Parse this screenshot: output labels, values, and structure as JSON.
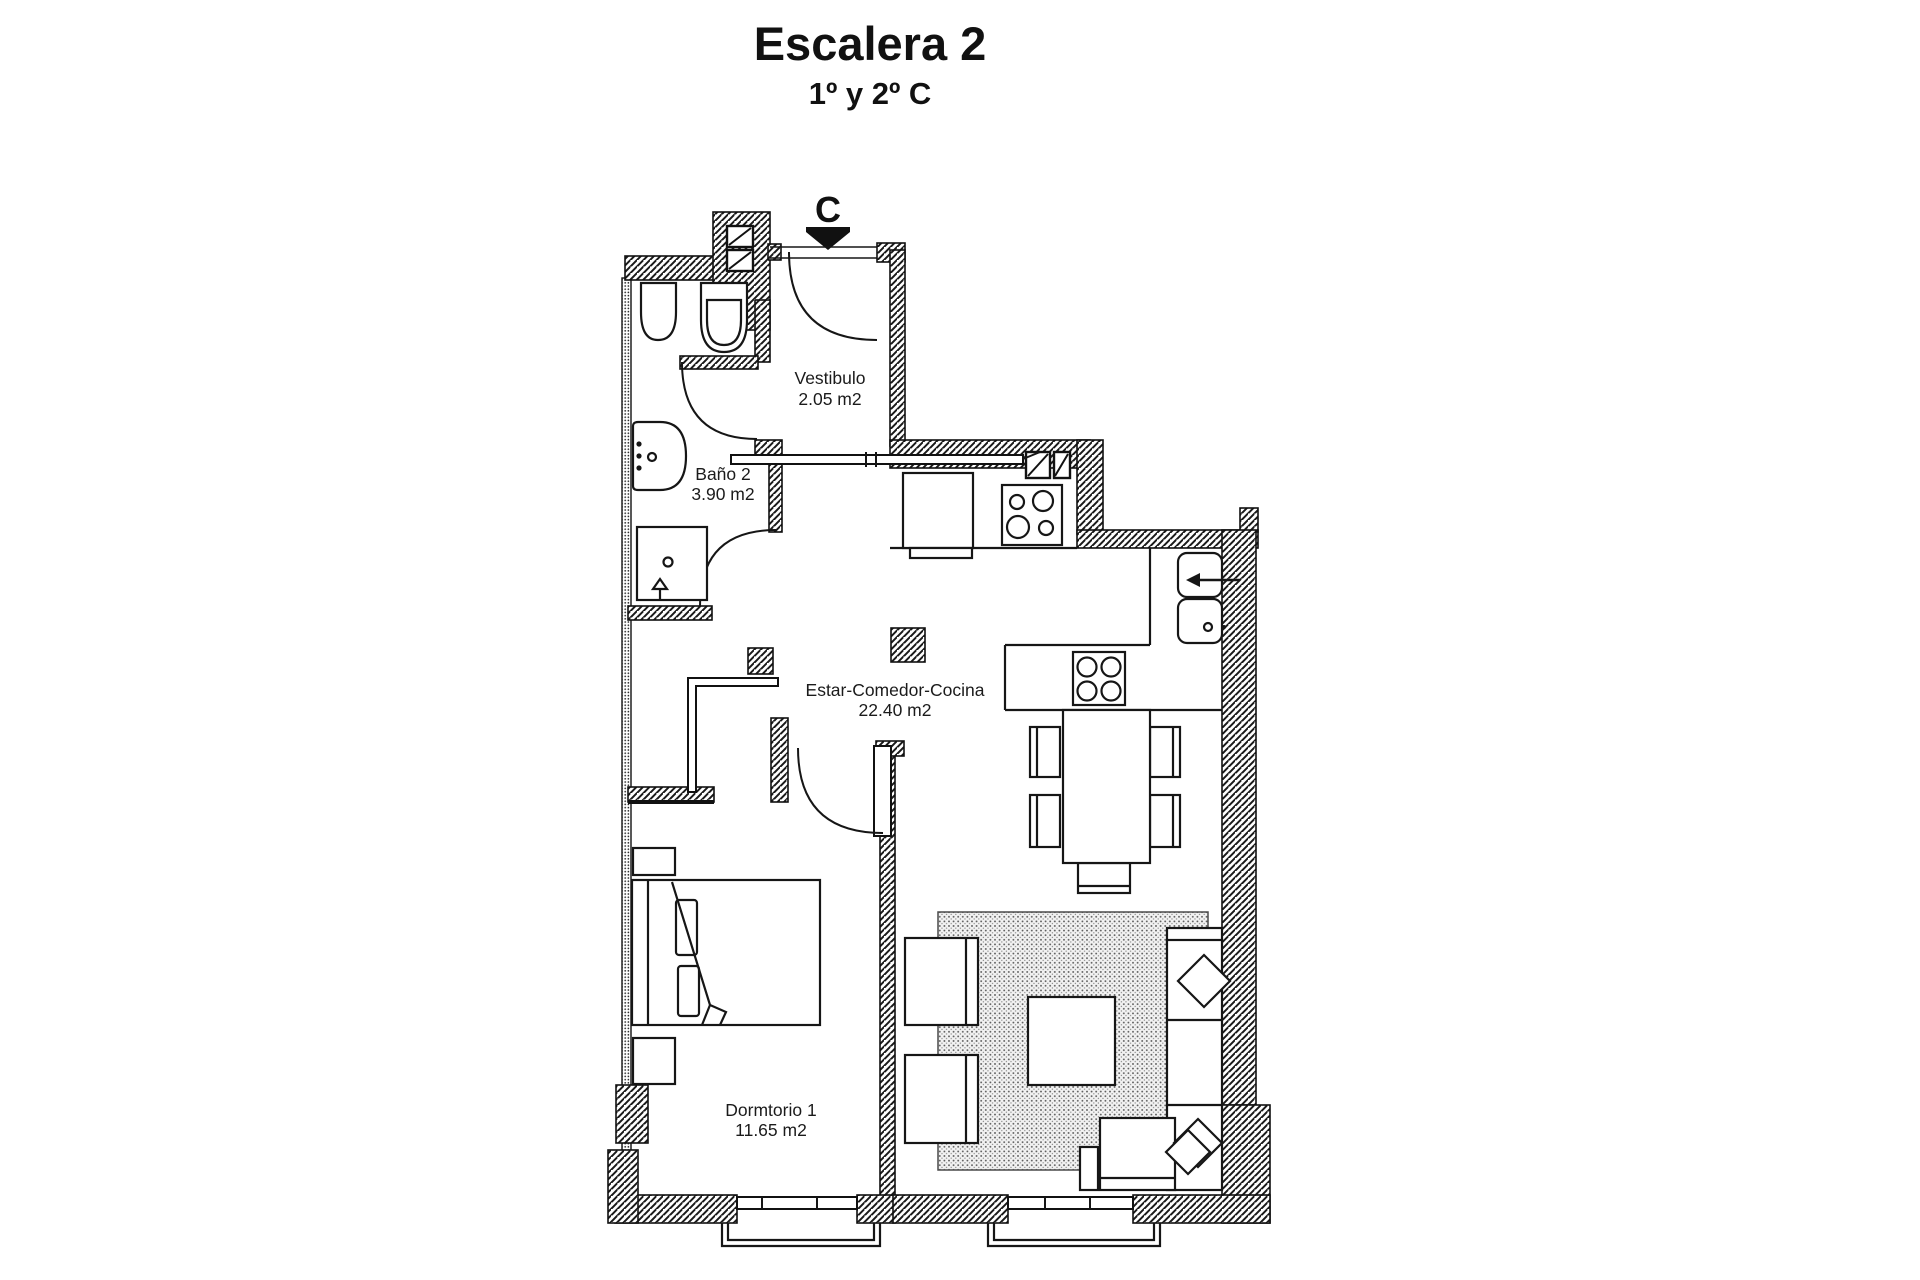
{
  "title": "Escalera 2",
  "subtitle": "1º y 2º C",
  "entrance": {
    "marker": "C"
  },
  "rooms": [
    {
      "name": "Vestibulo",
      "area": "2.05 m2"
    },
    {
      "name": "Baño 2",
      "area": "3.90 m2"
    },
    {
      "name": "Estar-Comedor-Cocina",
      "area": "22.40 m2"
    },
    {
      "name": "Dormtorio 1",
      "area": "11.65 m2"
    }
  ],
  "colors": {
    "ink": "#161616",
    "paper": "#ffffff"
  }
}
